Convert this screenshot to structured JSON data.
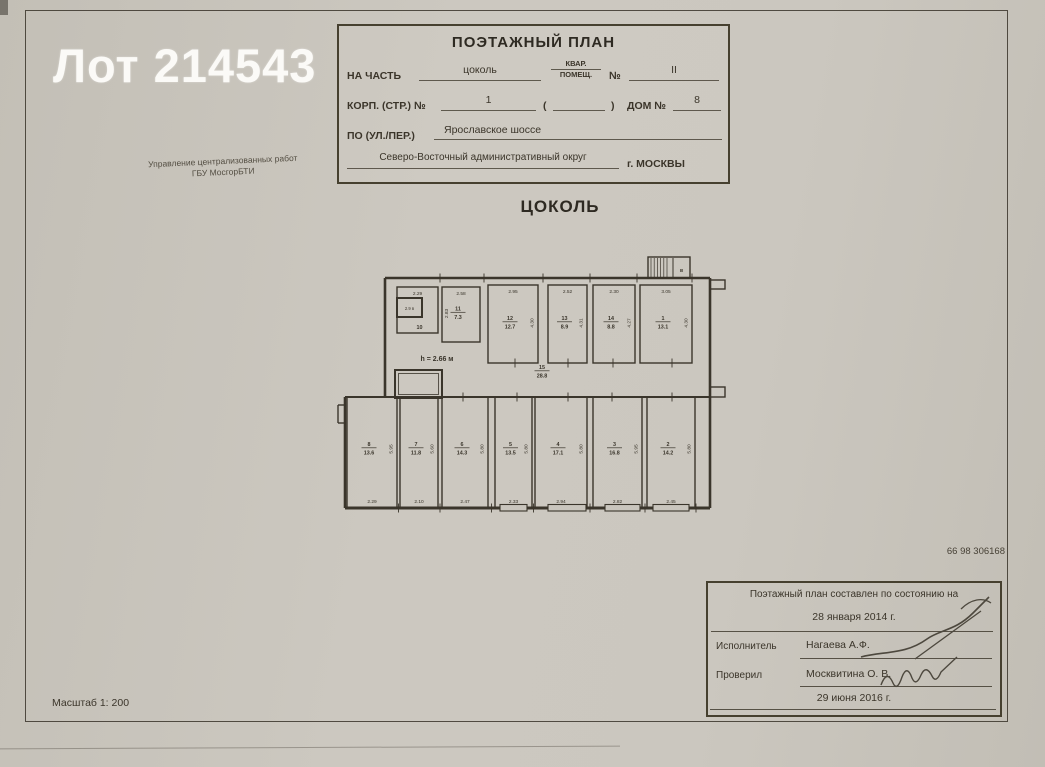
{
  "watermark": "Лот 214543",
  "organization": {
    "line1": "Управление централизованных работ",
    "line2": "ГБУ МосгорБТИ"
  },
  "title_block": {
    "title": "ПОЭТАЖНЫЙ ПЛАН",
    "na_chast_label": "НА ЧАСТЬ",
    "na_chast_value": "цоколь",
    "kvar_label": "КВАР.",
    "pomesh_label": "ПОМЕЩ.",
    "num_label": "№",
    "num_value": "II",
    "korp_label": "КОРП. (СТР.) №",
    "korp_value": "1",
    "paren_open": "(",
    "paren_close": ")",
    "dom_label": "ДОМ №",
    "dom_value": "8",
    "street_label": "ПО (УЛ./ПЕР.)",
    "street_value": "Ярославское шоссе",
    "okrug_value": "Северо-Восточный административный округ",
    "city_value": "г. МОСКВЫ"
  },
  "floor_title": "ЦОКОЛЬ",
  "doc_number": "66 98 306168",
  "scale_label": "Масштаб 1: 200",
  "stamp": {
    "line1": "Поэтажный план составлен по состоянию на",
    "date1": "28 января 2014 г.",
    "executor_label": "Исполнитель",
    "executor_name": "Нагаева А.Ф.",
    "checker_label": "Проверил",
    "checker_name": "Москвитина О. В.",
    "date2": "29 июня 2016 г."
  },
  "plan": {
    "height_note": "h = 2.66 м",
    "stair_label": "в",
    "closet_label": "2.9 в",
    "corridor": {
      "num": "15",
      "area": "28.8"
    },
    "rooms_top": [
      {
        "num": "10",
        "area": "",
        "top_dim": "2.29",
        "side_dim": ""
      },
      {
        "num": "11",
        "area": "7.3",
        "top_dim": "2.58",
        "side_dim": "2.83"
      },
      {
        "num": "12",
        "area": "12.7",
        "top_dim": "2.95",
        "side_dim": "4.30"
      },
      {
        "num": "13",
        "area": "8.9",
        "top_dim": "2.52",
        "side_dim": "4.31"
      },
      {
        "num": "14",
        "area": "8.8",
        "top_dim": "2.30",
        "side_dim": "4.27"
      },
      {
        "num": "1",
        "area": "13.1",
        "top_dim": "3.05",
        "side_dim": "4.30"
      }
    ],
    "rooms_bottom": [
      {
        "num": "8",
        "area": "13.6",
        "bottom_dim": "2.29",
        "side_dim": "5.95"
      },
      {
        "num": "7",
        "area": "11.8",
        "bottom_dim": "2.10",
        "side_dim": "5.60"
      },
      {
        "num": "6",
        "area": "14.3",
        "bottom_dim": "2.47",
        "side_dim": "5.80"
      },
      {
        "num": "5",
        "area": "13.5",
        "bottom_dim": "2.33",
        "side_dim": "5.80"
      },
      {
        "num": "4",
        "area": "17.1",
        "bottom_dim": "2.94",
        "side_dim": "5.80"
      },
      {
        "num": "3",
        "area": "16.8",
        "bottom_dim": "2.82",
        "side_dim": "5.95"
      },
      {
        "num": "2",
        "area": "14.2",
        "bottom_dim": "2.45",
        "side_dim": "5.80"
      }
    ]
  },
  "colors": {
    "ink": "#3a352b",
    "paper": "#c9c5bd"
  }
}
